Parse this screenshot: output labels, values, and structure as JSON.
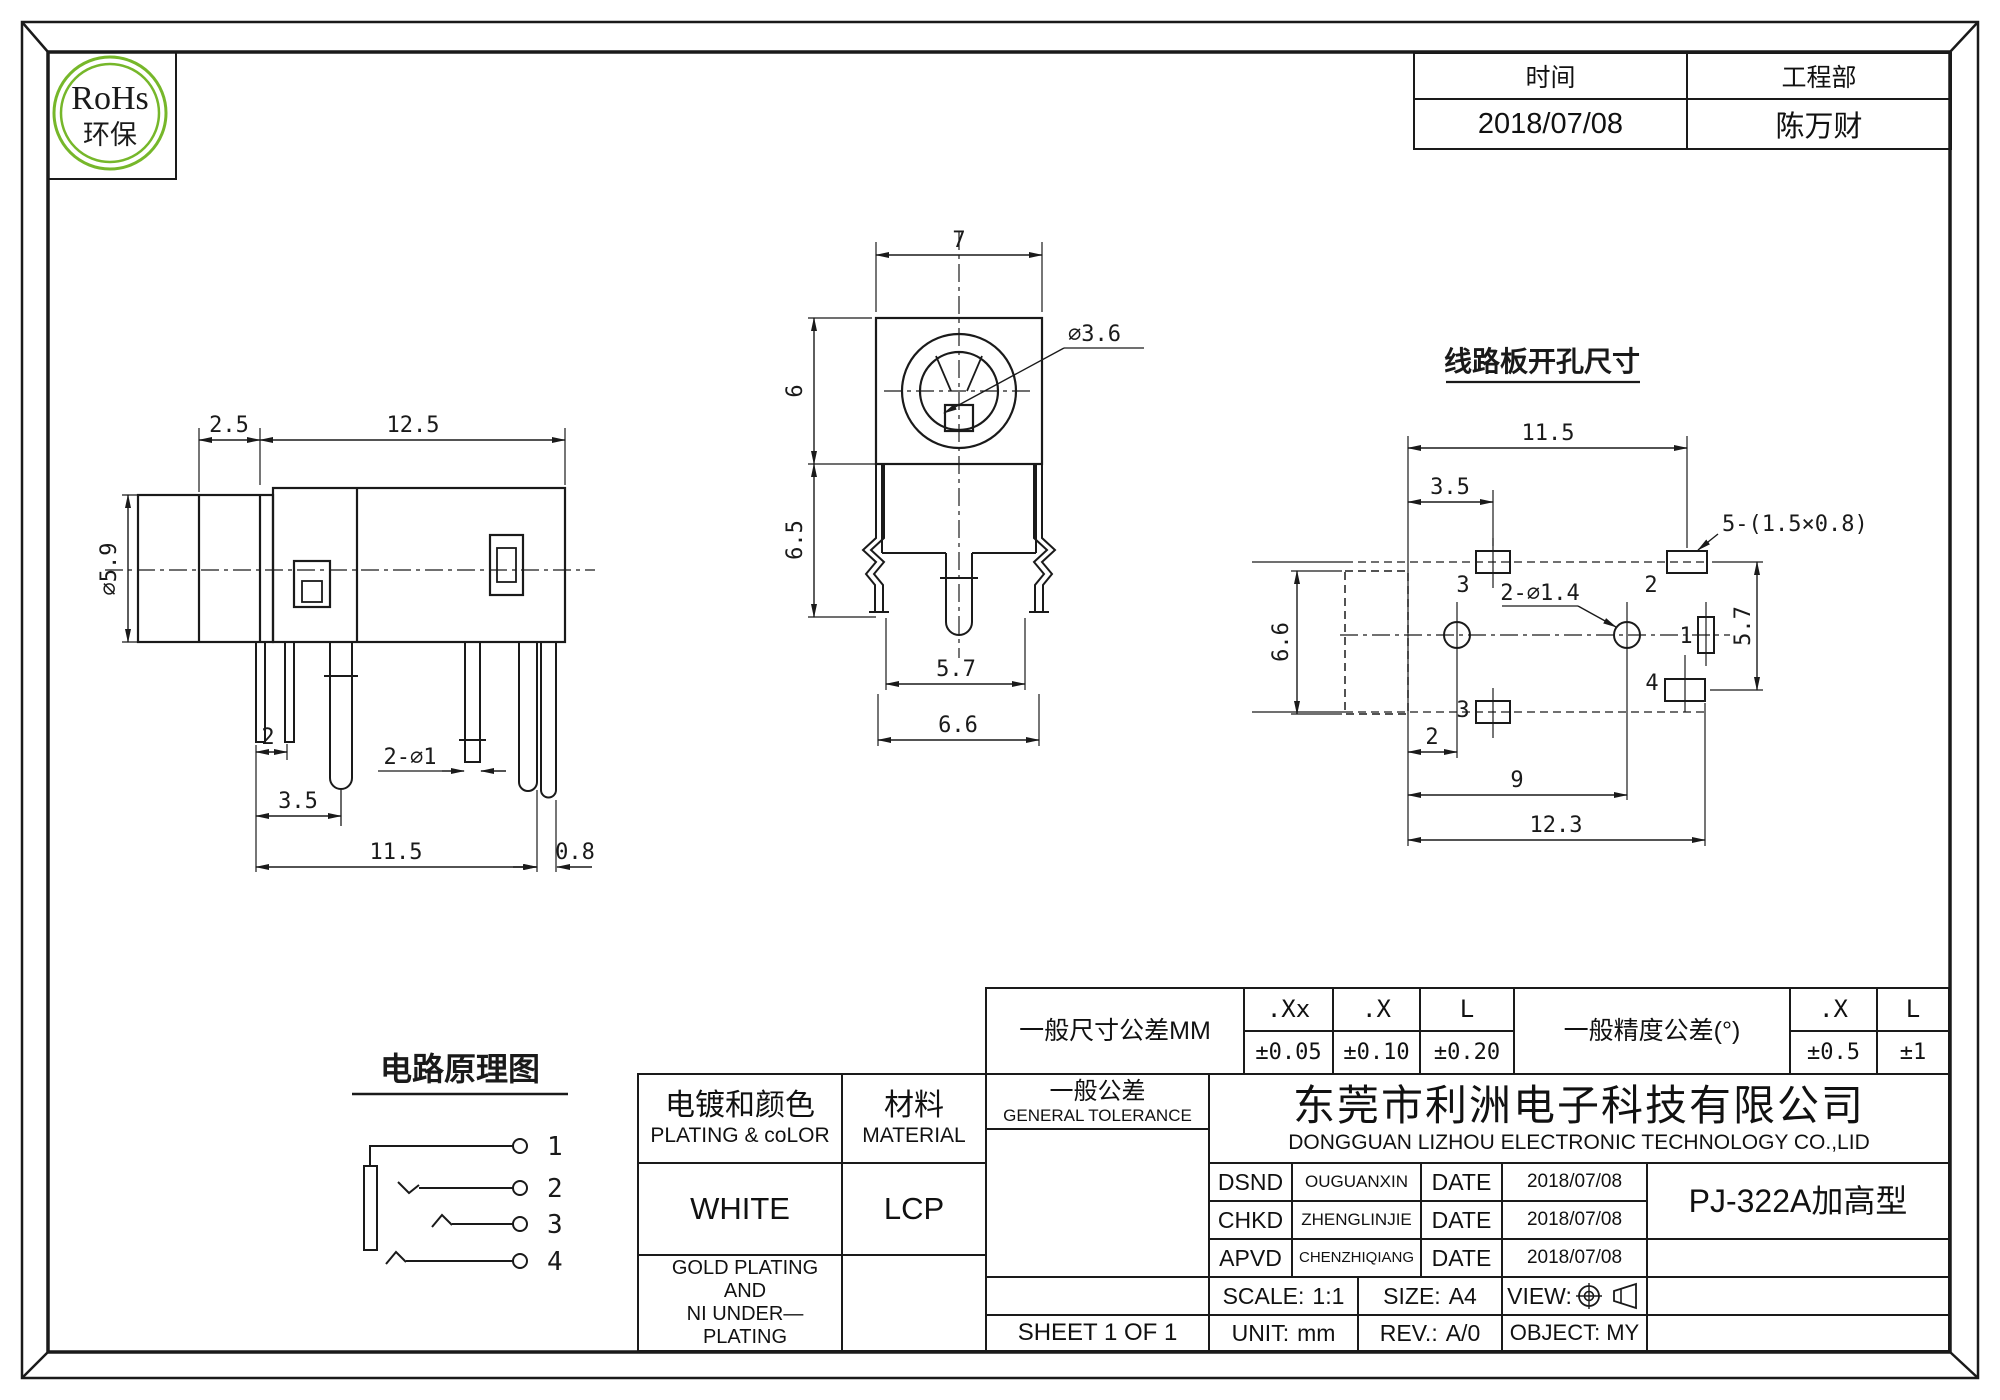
{
  "logo": {
    "title": "RoHs",
    "subtitle": "环保",
    "color": "#76b72a"
  },
  "stamp": {
    "time_label": "时间",
    "time_value": "2018/07/08",
    "dept_label": "工程部",
    "dept_value": "陈万财"
  },
  "side_view": {
    "d25": "2.5",
    "d125": "12.5",
    "d59": "∅5.9",
    "d2": "2",
    "d35": "3.5",
    "d2phi1": "2-∅1",
    "d115": "11.5",
    "d08": "0.8"
  },
  "front_view": {
    "d7": "7",
    "d6": "6",
    "d65": "6.5",
    "d36": "∅3.6",
    "d57": "5.7",
    "d66": "6.6"
  },
  "pcb_view": {
    "title": "线路板开孔尺寸",
    "d115": "11.5",
    "d35": "3.5",
    "slot": "5-(1.5×0.8)",
    "holes": "2-∅1.4",
    "d57": "5.7",
    "d66": "6.6",
    "d2": "2",
    "d9": "9",
    "d123": "12.3",
    "pad3_top": "3",
    "pad2": "2",
    "pad1": "1",
    "pad4": "4",
    "pad3_bottom": "3"
  },
  "schematic": {
    "title": "电路原理图",
    "pin1": "1",
    "pin2": "2",
    "pin3": "3",
    "pin4": "4"
  },
  "tolerance_table": {
    "dim_label": "一般尺寸公差MM",
    "col1": ".Xx",
    "col2": ".X",
    "col3": "L",
    "val1": "±0.05",
    "val2": "±0.10",
    "val3": "±0.20",
    "angle_label": "一般精度公差(°)",
    "acol1": ".X",
    "acol2": "L",
    "aval1": "±0.5",
    "aval2": "±1"
  },
  "title_block": {
    "plating": {
      "cn": "电镀和颜色",
      "en": "PLATING & coLOR",
      "value": "WHITE",
      "note1": "GOLD PLATING AND",
      "note2": "NI UNDER—PLATING"
    },
    "material": {
      "cn": "材料",
      "en": "MATERIAL",
      "value": "LCP"
    },
    "general_tolerance": {
      "cn": "一般公差",
      "en": "GENERAL TOLERANCE"
    },
    "company": {
      "cn": "东莞市利洲电子科技有限公司",
      "en": "DONGGUAN LIZHOU ELECTRONIC TECHNOLOGY CO.,LID"
    },
    "approvals": [
      {
        "role": "DSND",
        "name": "OUGUANXIN",
        "date_label": "DATE",
        "date": "2018/07/08"
      },
      {
        "role": "CHKD",
        "name": "ZHENGLINJIE",
        "date_label": "DATE",
        "date": "2018/07/08"
      },
      {
        "role": "APVD",
        "name": "CHENZHIQIANG",
        "date_label": "DATE",
        "date": "2018/07/08"
      }
    ],
    "part_name": "PJ-322A加高型",
    "scale": {
      "label": "SCALE:",
      "value": "1:1"
    },
    "size": {
      "label": "SIZE:",
      "value": "A4"
    },
    "view": {
      "label": "VIEW:"
    },
    "sheet": "SHEET 1 OF 1",
    "unit": {
      "label": "UNIT:",
      "value": "mm"
    },
    "rev": {
      "label": "REV.:",
      "value": "A/0"
    },
    "object": {
      "label": "OBJECT:",
      "value": "MY"
    }
  }
}
